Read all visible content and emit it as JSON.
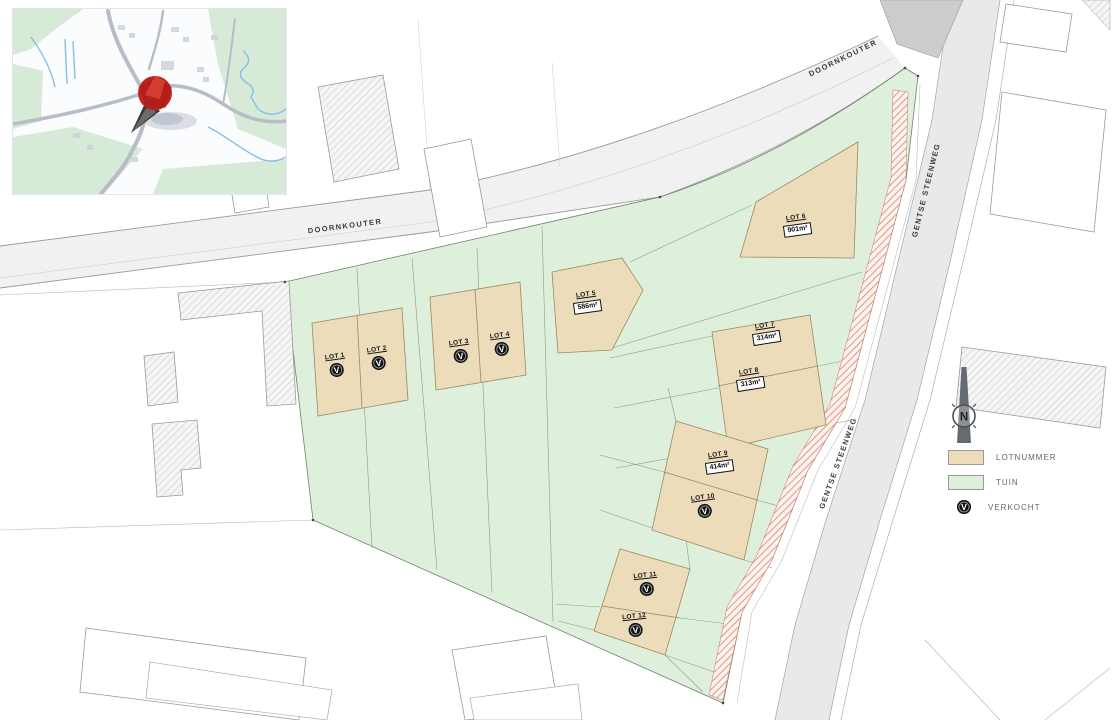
{
  "streets": {
    "doornkouter": "DOORNKOUTER",
    "gentse_steenweg": "GENTSE STEENWEG"
  },
  "north_label": "N",
  "glyphs": {
    "sold": "V"
  },
  "legend": {
    "lotnummer": "LOTNUMMER",
    "tuin": "TUIN",
    "verkocht": "VERKOCHT"
  },
  "lots": [
    {
      "name": "LOT 1",
      "sold": true
    },
    {
      "name": "LOT 2",
      "sold": true
    },
    {
      "name": "LOT 3",
      "sold": true
    },
    {
      "name": "LOT 4",
      "sold": true
    },
    {
      "name": "LOT 5",
      "area": "586m²",
      "sold": false
    },
    {
      "name": "LOT 6",
      "area": "901m²",
      "sold": false
    },
    {
      "name": "LOT 7",
      "area": "314m²",
      "sold": false
    },
    {
      "name": "LOT 8",
      "area": "313m²",
      "sold": false
    },
    {
      "name": "LOT 9",
      "area": "414m²",
      "sold": false
    },
    {
      "name": "LOT 10",
      "sold": true
    },
    {
      "name": "LOT 11",
      "sold": true
    },
    {
      "name": "LOT 12",
      "sold": true
    }
  ],
  "colors": {
    "lot_fill": "#ecdcba",
    "tuin_fill": "#def0dc",
    "sold_badge": "#101010",
    "red_strip_line": "#d6705a",
    "road_fill": "#f1f1f3",
    "road_band": "#e9e9ec",
    "junction_grey": "#cbccce",
    "pin_red": "#c22420"
  }
}
